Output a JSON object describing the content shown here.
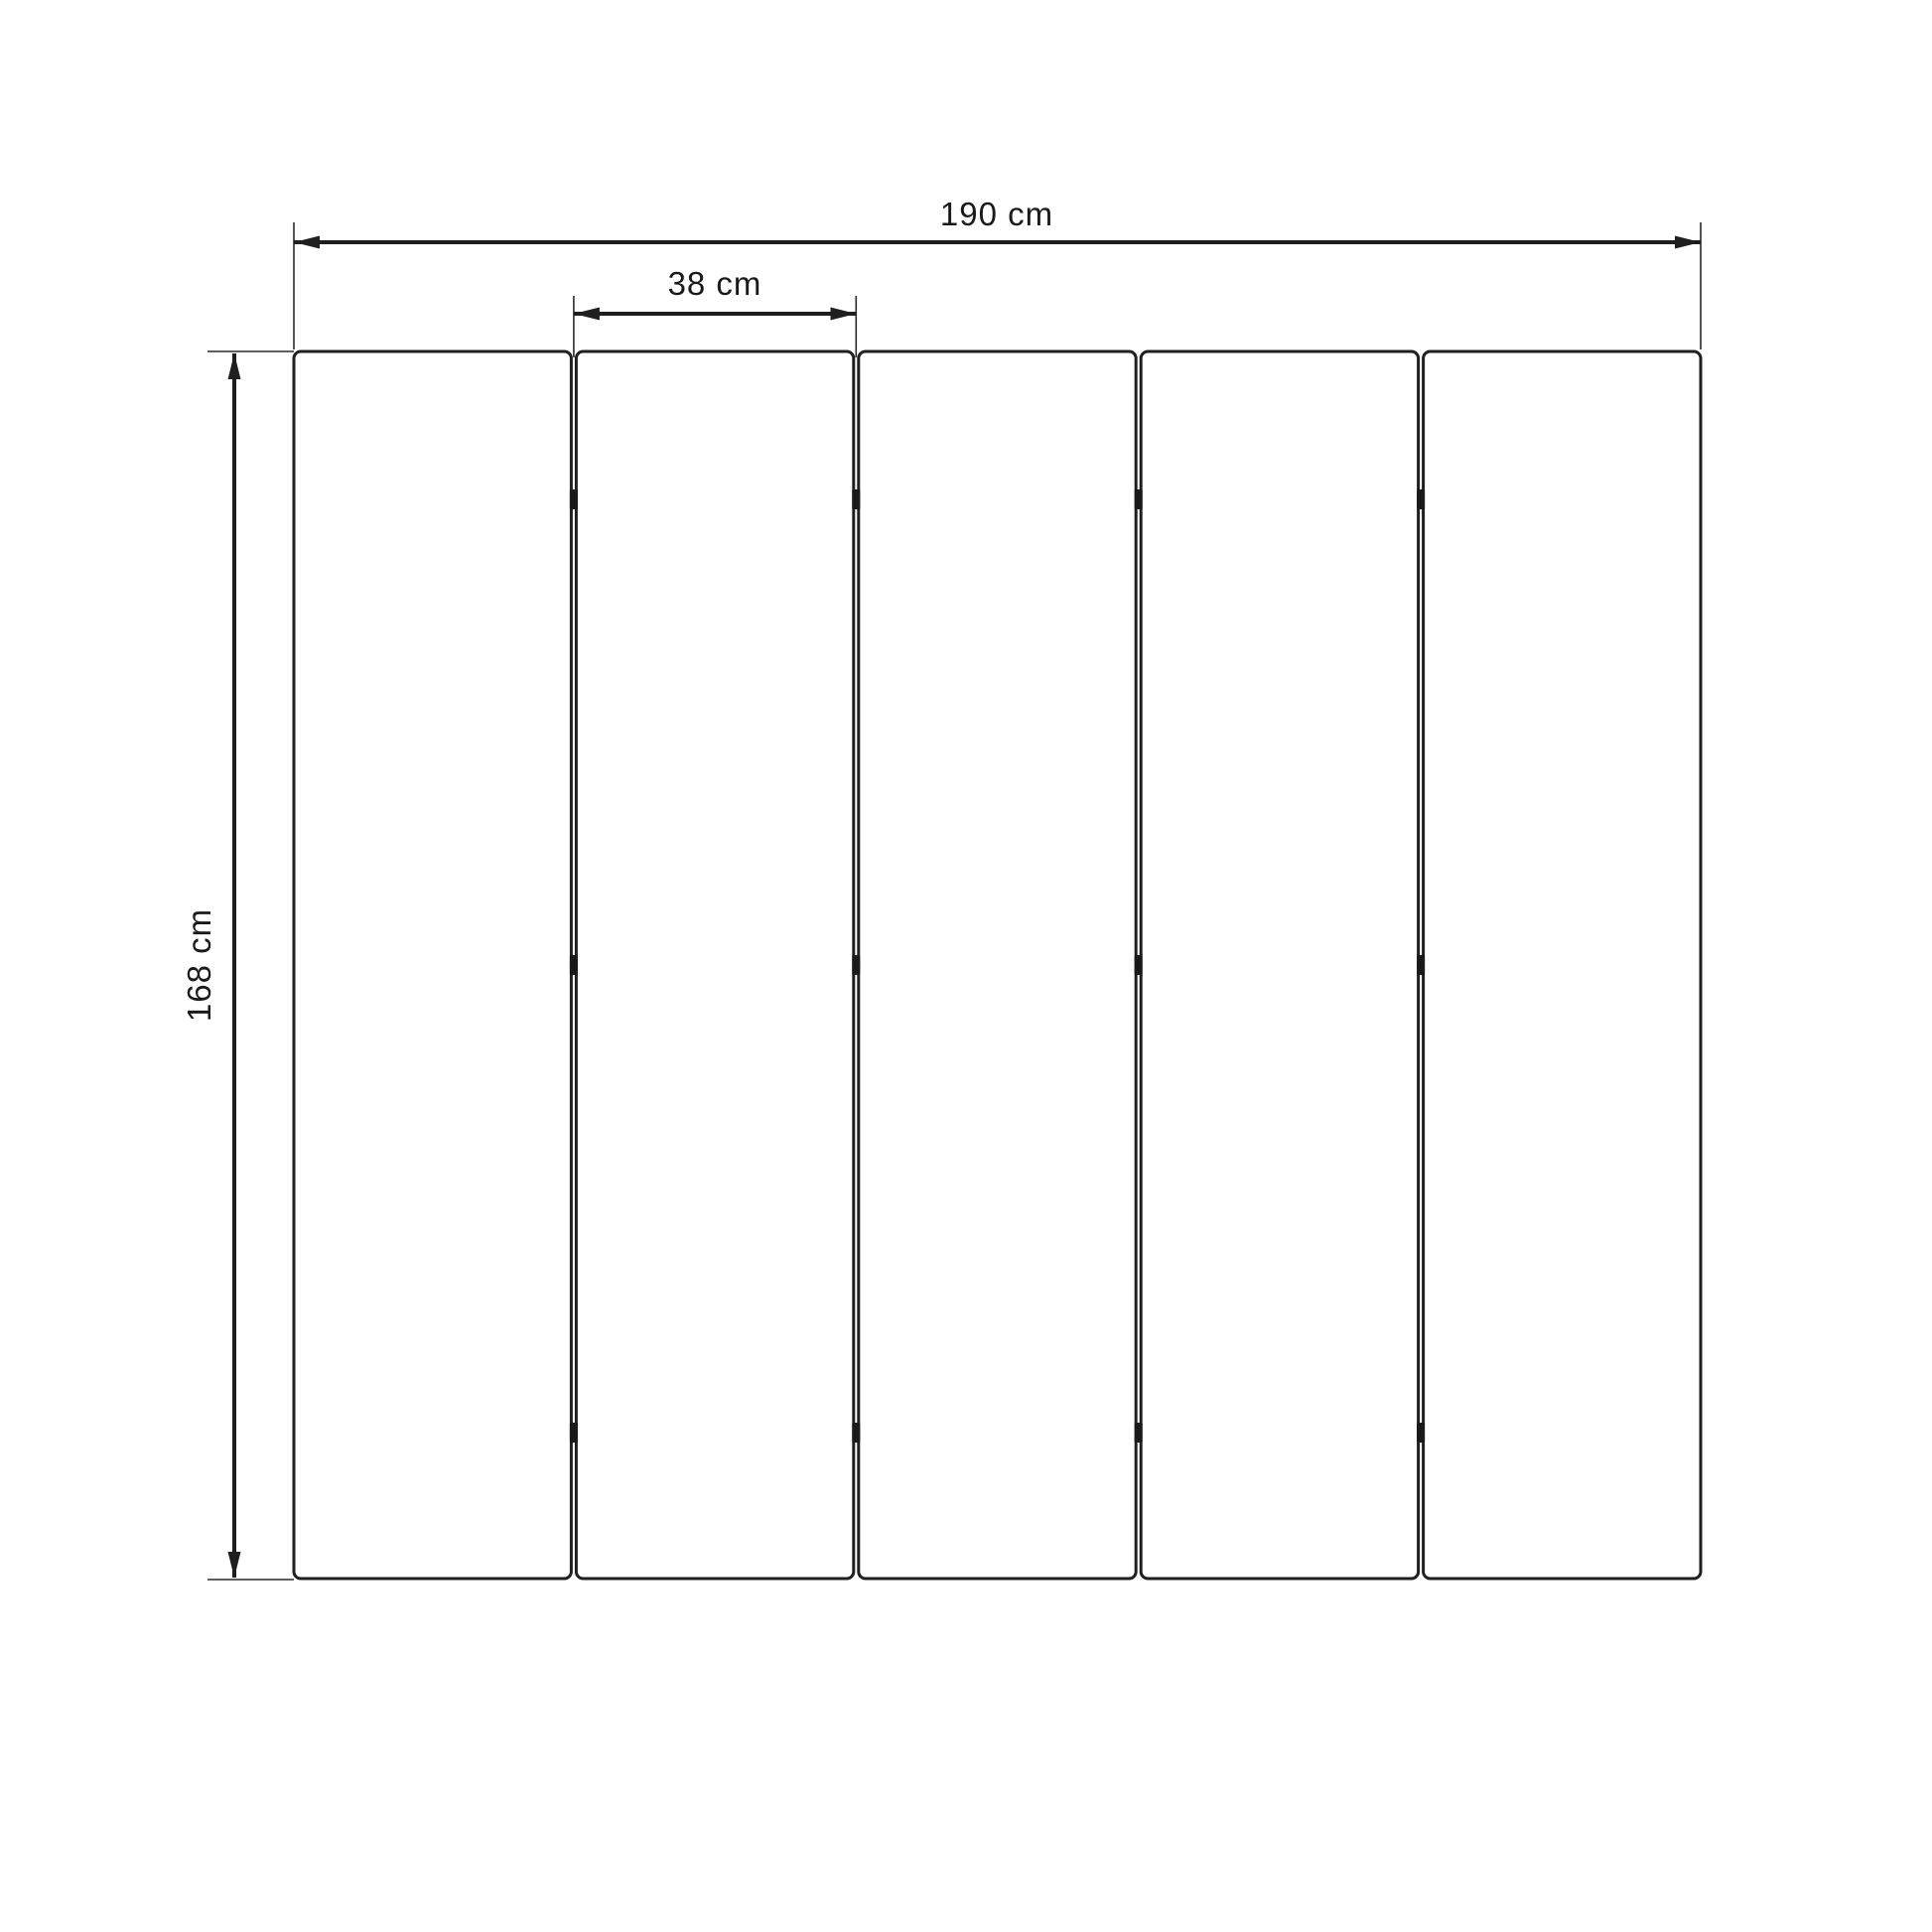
{
  "diagram": {
    "type": "furniture-dimension-drawing",
    "subject": "five-panel folding screen, front elevation",
    "panel_count": 5,
    "hinges_per_gap": 3,
    "dimensions": {
      "total_width": {
        "label": "190 cm",
        "value_cm": 190
      },
      "panel_width": {
        "label": "38 cm",
        "value_cm": 38
      },
      "height": {
        "label": "168 cm",
        "value_cm": 168
      }
    },
    "colors": {
      "background": "#ffffff",
      "stroke": "#1f1f1f",
      "hinge": "#1a1a1a",
      "text": "#1a1a1a"
    }
  }
}
